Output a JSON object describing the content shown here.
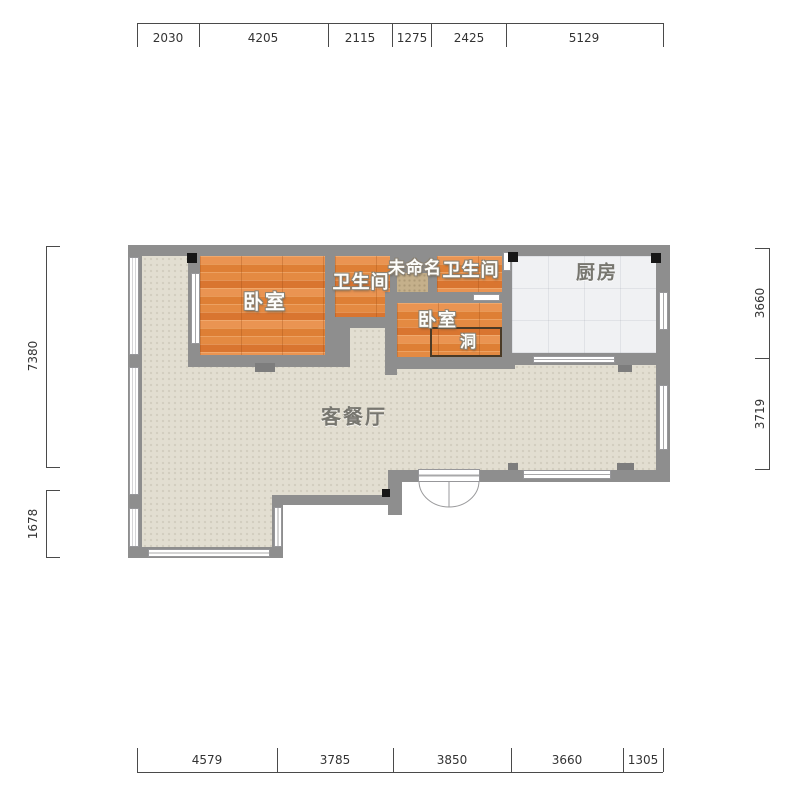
{
  "plan": {
    "rooms": {
      "bedroom1": {
        "label": "卧室"
      },
      "bathroom1": {
        "label": "卫生间"
      },
      "unnamed": {
        "label": "未命名"
      },
      "bathroom2": {
        "label": "卫生间"
      },
      "kitchen": {
        "label": "厨房"
      },
      "bedroom2": {
        "label": "卧室"
      },
      "hole": {
        "label": "洞"
      },
      "living": {
        "label": "客餐厅"
      }
    },
    "dimensions_mm": {
      "top": [
        "2030",
        "4205",
        "2115",
        "1275",
        "2425",
        "5129"
      ],
      "bottom": [
        "4579",
        "3785",
        "3850",
        "3660",
        "1305"
      ],
      "left": [
        "7380",
        "1678"
      ],
      "right": [
        "3660",
        "3719"
      ]
    },
    "colors": {
      "wall": "#8e8e8e",
      "wall_pillar": "#7d7d7d",
      "wood_floor": "#e0823b",
      "living_floor": "#e2ded1",
      "kitchen_floor": "#f0f1f3",
      "unnamed_floor": "#c5b08b",
      "corner_marker": "#161616",
      "hole_outline": "#4a3a26",
      "dimension_text": "#333333"
    }
  }
}
